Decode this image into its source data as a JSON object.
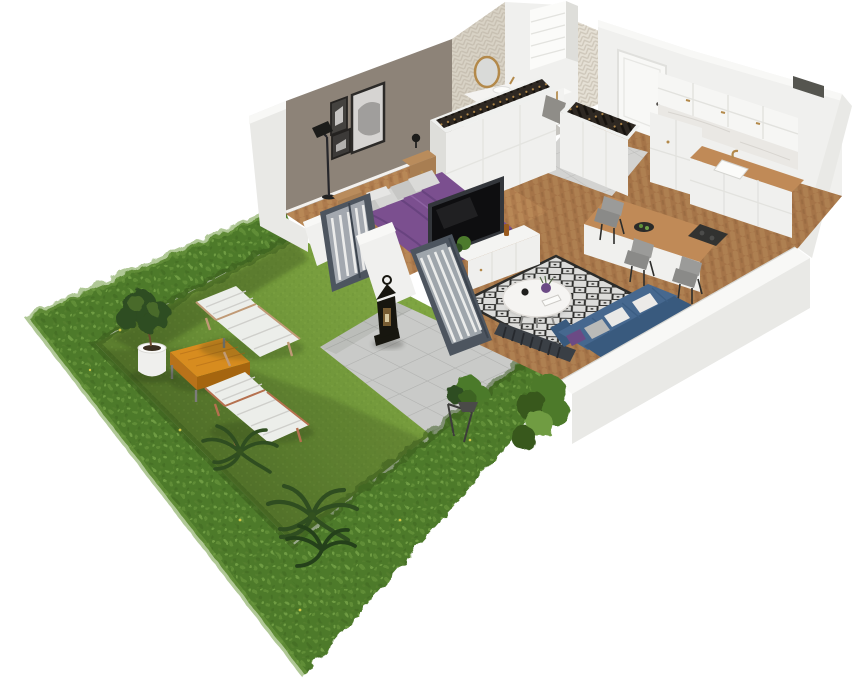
{
  "scene": {
    "type": "3d-floorplan-render",
    "description_visible_text": ""
  },
  "colors": {
    "background": "#ffffff",
    "hedge_base": "#4e7a2b",
    "hedge_dark": "#37591c",
    "hedge_light": "#6f9c43",
    "flower_yellow": "#d4c94a",
    "lawn_light": "#86ac45",
    "lawn_mid": "#6d9338",
    "lawn_shadow": "#4f6e28",
    "patio_tile": "#c9cac8",
    "patio_line": "#b0b1af",
    "wall_white": "#f0f0ee",
    "wall_outer": "#e9e9e6",
    "wall_top": "#f8f8f6",
    "wall_shade": "#dededa",
    "bedroom_wall": "#8d8378",
    "wood_floor": "#ae7b4d",
    "wood_light": "#c2945f",
    "wood_dark": "#96683e",
    "wood_counter": "#c08a57",
    "hall_tile": "#d3d3d1",
    "bath_floor": "#c6c4bf",
    "bath_tile": "#d8d2c5",
    "bath_tile_light": "#e5e0d5",
    "bed_purple": "#7b4f8f",
    "bed_purple_dark": "#64407a",
    "pillow_gray": "#c7c7c5",
    "sofa_blue": "#46688f",
    "sofa_blue_dark": "#395a7e",
    "pillow_purple": "#6b4a85",
    "rug_base": "#dcdcda",
    "rug_ink": "#2c2c2a",
    "table_orange": "#d78c1f",
    "table_orange_dark": "#b8721a",
    "door_frame": "#4d555f",
    "curtain_white": "#f4f4f2",
    "lantern_black": "#17160f",
    "gold": "#b3894a",
    "marble": "#eae8e4",
    "plant_green": "#4c7a2c",
    "plant_dark": "#2f4d20",
    "palm_dark": "#24401a",
    "pot_white": "#efefed",
    "furniture_wood": "#b98c5c",
    "furniture_wood_dark": "#a87e52",
    "chair_gray": "#9b9b99",
    "tv_black": "#0e0e10",
    "tv_panel": "#33363b",
    "radiator_dark": "#3a3f45",
    "glass_gray": "#aab0b6",
    "clothes_dark": "#2e2822",
    "lounger_white": "#eceeea",
    "lounger_frame": "#c09a76"
  }
}
